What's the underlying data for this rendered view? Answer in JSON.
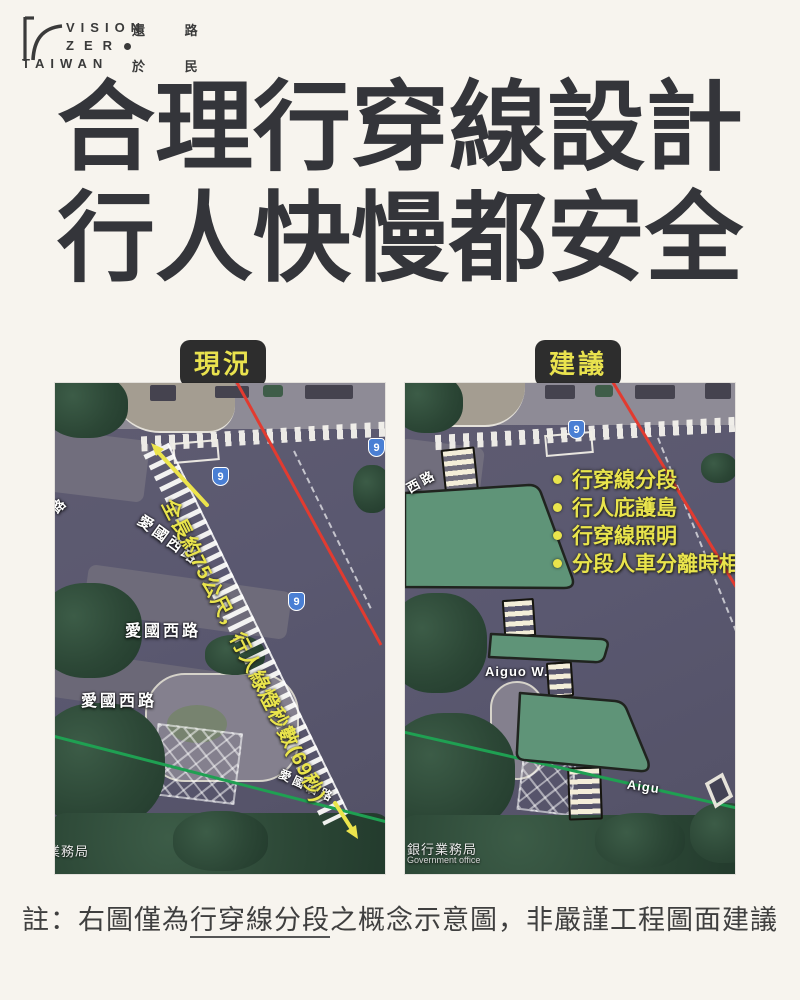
{
  "logo": {
    "brand_line1": "VISION",
    "brand_line2": "ZER",
    "brand_line3": "TAIWAN",
    "cjk_top": "還 路",
    "cjk_bottom": "於 民"
  },
  "title": {
    "line1": "合理行穿線設計",
    "line2": "行人快慢都安全"
  },
  "left_panel": {
    "badge": "現況",
    "annotation": "全長約75公尺，行人綠燈秒數(69秒)",
    "route_shield": "9",
    "labels": {
      "edge": "路",
      "diag": "愛國西路",
      "row1": "愛國西路",
      "row2": "愛國西路",
      "small": "愛國西路"
    },
    "credit": "業務局"
  },
  "right_panel": {
    "badge": "建議",
    "bullets": [
      "行穿線分段",
      "行人庇護島",
      "行穿線照明",
      "分段人車分離時相"
    ],
    "route_shield": "9",
    "labels": {
      "edge": "西路",
      "aiguo_w": "Aiguo W.",
      "aiguo": "Aigu"
    },
    "credit": "銀行業務局",
    "credit_sub": "Government office"
  },
  "footnote": {
    "prefix": "註：右圖僅為",
    "underline": "行穿線分段",
    "suffix": "之概念示意圖，非嚴謹工程圖面建議"
  },
  "colors": {
    "accent_yellow": "#e9e44c",
    "badge_bg": "#2d2d2d",
    "island_green": "#5f9478",
    "route_red": "#e23b30",
    "route_green": "#27a35a",
    "shield_blue": "#4a7fd4",
    "background": "#f7f4ee",
    "title_ink": "#34353a"
  }
}
